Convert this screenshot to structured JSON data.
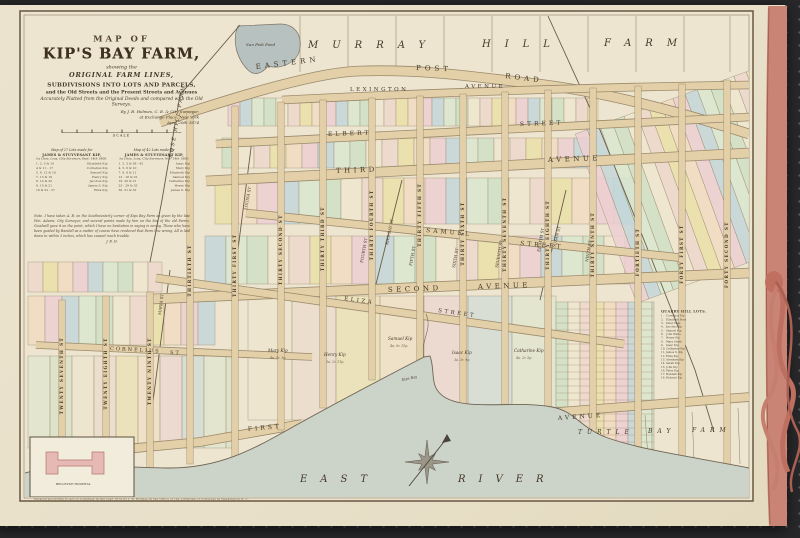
{
  "photo": {
    "bg": "#28282a",
    "paper": "#e9e1ca",
    "cloth": "#c98476",
    "ribbon": "#b86a5c"
  },
  "title_block": {
    "line1": "MAP OF",
    "line2": "KIP'S BAY FARM,",
    "line3": "showing the",
    "line4": "ORIGINAL FARM LINES,",
    "line5": "SUBDIVISIONS INTO LOTS AND PARCELS,",
    "line6": "and the Old Streets and the Present Streets and Avenues",
    "line7": "Accurately Platted from the Original Deeds and compared with the Old Surveys.",
    "by1": "By J. B. Holmes, C. E. & City Surveyor,",
    "by2": "at Exchange Place, New York",
    "by3": "April 20th 1874",
    "scale_label": "SCALE"
  },
  "legend_tables": [
    {
      "title1": "Map of 27 Lots made for",
      "title2": "JAMES & STUYVESANT KIP,",
      "title3": "by Chas. Loss, City Surveyor, Sept. 14th 1806.",
      "rows": [
        [
          "1. 2. 3 & 10",
          "Elizabeth Kip"
        ],
        [
          "4 & 11 - 17",
          "Cornelius Kip"
        ],
        [
          "5. 6. 12 & 18",
          "Samuel Kip"
        ],
        [
          "7. 13 & 19",
          "Henry Kip"
        ],
        [
          "8. 14 & 20",
          "Jacobus Kip"
        ],
        [
          "9. 15 & 21",
          "James S. Kip"
        ],
        [
          "16 & 22 - 27",
          "Eliza Kip"
        ]
      ]
    },
    {
      "title1": "Map of 42 Lots made for",
      "title2": "JAMES & STUYVESANT KIP,",
      "title3": "by Chas. Loss, City Surveyor, Nov. 14th 1806.",
      "rows": [
        [
          "1. 2. 3 & 38 - 42",
          "Isaac Kip"
        ],
        [
          "4. 5. 6 & 10",
          "Mary Kip"
        ],
        [
          "7. 8. 9 & 11",
          "Elizabeth Kip"
        ],
        [
          "12 - 18 & 22",
          "Samuel Kip"
        ],
        [
          "19. 20 & 21",
          "Catharine Kip"
        ],
        [
          "23 - 29 & 33",
          "Henry Kip"
        ],
        [
          "30. 31 & 32",
          "James S. Kip"
        ]
      ]
    }
  ],
  "note": {
    "text": "Note. I have taken A. B. on the Southwesterly corner of Kips Bay Farm as given by the late Wm. Adams, City Surveyor, and several points made by him on the line of the old Farms. Goodwill gave it on the point, which I have no hesitation in saying is wrong. Those who have been guided by Randell as a matter of course have rendered that Farm line wrong. All is laid down to within 3 inches, which has caused much trouble.",
    "sig": "J. B. H."
  },
  "quarry_list": {
    "title": "QUARRY HILL LOTS.",
    "entries": [
      "Cornelius Kip",
      "Elizabeth Ross",
      "Peter Praa",
      "Jacobus Kip",
      "Samuel Kip",
      "John Watts",
      "Henry Kip",
      "Mary Smith",
      "Isaac Kip",
      "Catharine Kip",
      "James S. Kip",
      "Eliza Kip",
      "Abraham Kip",
      "Sarah Kip",
      "John Kip",
      "Peter Kip",
      "Hannah Kip",
      "Richard Kip"
    ]
  },
  "imprint": "Entered according to Act of Congress in the year 1874 by J. B. Holmes in the Office of the Librarian of Congress at Washington D. C.",
  "inset": {
    "label": "BELLEVUE HOSPITAL"
  },
  "map": {
    "colors": {
      "road_fill": "#e3d0a9",
      "road_edge": "#9b8a6b",
      "water": "#ccd3c9",
      "shore": "#6f6553",
      "pond": "#b7c1bf",
      "line": "#8a7a5e",
      "label": "#45382a",
      "lots": [
        "#eccfd2",
        "#cfe0c4",
        "#eae0a9",
        "#c3d7d9",
        "#efe6cf",
        "#f1dcc1",
        "#d9e6cf",
        "#ecd8cc"
      ]
    },
    "roads": [
      {
        "name": "eastern-post-road",
        "d": "M 160 122 C 250 92 320 72 360 71 C 430 69 480 78 530 83 C 610 92 690 115 749 134",
        "w": 9
      },
      {
        "name": "lexington-avenue",
        "d": "M 282 100 C 420 93 600 87 749 85",
        "w": 7
      },
      {
        "name": "elbert-street",
        "d": "M 216 144 L 749 117",
        "w": 7
      },
      {
        "name": "third-avenue",
        "d": "M 206 181 L 749 153",
        "w": 9
      },
      {
        "name": "samuel-street",
        "d": "M 246 213 L 684 258",
        "w": 7
      },
      {
        "name": "second-avenue",
        "d": "M 152 299 L 749 273",
        "w": 9
      },
      {
        "name": "eliza-street",
        "d": "M 156 278 L 624 344",
        "w": 7
      },
      {
        "name": "cornelius-street",
        "d": "M 36 345 L 312 357",
        "w": 6
      },
      {
        "name": "first-avenue-west",
        "d": "M 30 458 L 200 442 L 302 424",
        "w": 8
      },
      {
        "name": "first-avenue-east",
        "d": "M 520 415 L 749 397",
        "w": 8
      }
    ],
    "vertical_streets": [
      {
        "name": "TWENTY SEVENTH ST",
        "x": 62,
        "y1": 300,
        "y2": 468
      },
      {
        "name": "TWENTY EIGHTH ST",
        "x": 106,
        "y1": 296,
        "y2": 468
      },
      {
        "name": "TWENTY NINTH ST",
        "x": 150,
        "y1": 292,
        "y2": 468
      },
      {
        "name": "THIRTIETH ST",
        "x": 190,
        "y1": 112,
        "y2": 464
      },
      {
        "name": "THIRTY FIRST ST",
        "x": 235,
        "y1": 106,
        "y2": 460
      },
      {
        "name": "THIRTY SECOND ST",
        "x": 281,
        "y1": 102,
        "y2": 430
      },
      {
        "name": "THIRTY THIRD ST",
        "x": 323,
        "y1": 100,
        "y2": 408
      },
      {
        "name": "THIRTY FOURTH ST",
        "x": 372,
        "y1": 98,
        "y2": 380
      },
      {
        "name": "THIRTY FIFTH ST",
        "x": 420,
        "y1": 96,
        "y2": 360
      },
      {
        "name": "THIRTY SIXTH ST",
        "x": 463,
        "y1": 94,
        "y2": 404
      },
      {
        "name": "THIRTY SEVENTH ST",
        "x": 505,
        "y1": 92,
        "y2": 408
      },
      {
        "name": "THIRTY EIGHTH ST",
        "x": 548,
        "y1": 90,
        "y2": 412
      },
      {
        "name": "THIRTY NINTH ST",
        "x": 593,
        "y1": 88,
        "y2": 436
      },
      {
        "name": "FORTIETH ST",
        "x": 638,
        "y1": 86,
        "y2": 455
      },
      {
        "name": "FORTY FIRST ST",
        "x": 682,
        "y1": 84,
        "y2": 462
      },
      {
        "name": "FORTY SECOND ST",
        "x": 727,
        "y1": 80,
        "y2": 468
      }
    ],
    "old_street_lines": [
      "M 252 140 L 236 265",
      "M 170 270 L 148 440",
      "M 402 180 L 372 300",
      "M 566 190 L 540 300",
      "M 548 16 L 600 130 L 650 255 L 695 370 L 714 432",
      "M 240 25 L 180 95 L 162 200 L 150 262"
    ],
    "murray_xs": [
      300,
      348,
      396,
      444,
      492,
      540,
      588,
      636,
      684,
      730
    ],
    "turtle_lines": [
      "M 645 415 L 648 458",
      "M 692 412 L 694 460",
      "M 738 408 L 740 464"
    ],
    "lot_bands": [
      {
        "x1": 228,
        "x2": 598,
        "y1": 98,
        "y2": 126,
        "w": 12
      },
      {
        "x1": 222,
        "x2": 598,
        "y1": 138,
        "y2": 168,
        "w": 16
      },
      {
        "x1": 215,
        "x2": 640,
        "y1": 178,
        "y2": 224,
        "w": 21
      },
      {
        "x1": 205,
        "x2": 640,
        "y1": 236,
        "y2": 284,
        "w": 21
      },
      {
        "x1": 248,
        "x2": 556,
        "y1": 296,
        "y2": 420,
        "w": 44,
        "pale": 1
      },
      {
        "x1": 28,
        "x2": 215,
        "y1": 296,
        "y2": 345,
        "w": 17
      },
      {
        "x1": 28,
        "x2": 232,
        "y1": 356,
        "y2": 448,
        "w": 22,
        "pale": 1
      },
      {
        "x1": 28,
        "x2": 162,
        "y1": 262,
        "y2": 292,
        "w": 15
      },
      {
        "x1": 600,
        "x2": 790,
        "y1": 105,
        "y2": 285,
        "w": 13,
        "rot": -20,
        "rcx": 670,
        "rcy": 190
      },
      {
        "x1": 556,
        "x2": 654,
        "y1": 302,
        "y2": 466,
        "w": 12,
        "rows": 7
      }
    ],
    "water": {
      "fill_d": "M 25 473 C 70 460 120 468 170 468 C 225 468 260 445 300 423 C 345 398 395 372 424 357 L 430 356 C 436 372 428 388 446 398 C 470 411 515 400 552 407 C 575 411 580 428 608 438 C 645 451 700 458 749 468 L 749 497 L 25 497 Z",
      "shore_d": "M 25 473 C 70 460 120 468 170 468 C 225 468 260 445 300 423 C 345 398 395 372 424 357 L 430 356 C 436 372 428 388 446 398 C 470 411 515 400 552 407 C 575 411 580 428 608 438 C 645 451 700 458 749 468",
      "creek_d": "M 424 357 C 420 340 433 330 426 314"
    },
    "labels": [
      {
        "t": "MURRAY",
        "x": 308,
        "y": 48,
        "s": 10,
        "ls": 14,
        "i": 1
      },
      {
        "t": "HILL",
        "x": 482,
        "y": 47,
        "s": 10,
        "ls": 14,
        "i": 1
      },
      {
        "t": "FARM",
        "x": 604,
        "y": 46,
        "s": 10,
        "ls": 14,
        "i": 1
      },
      {
        "t": "Sun Fish Pond",
        "x": 246,
        "y": 46,
        "s": 4,
        "i": 1
      },
      {
        "t": "EASTERN",
        "x": 256,
        "y": 69,
        "s": 7,
        "ls": 4,
        "r": -7
      },
      {
        "t": "POST",
        "x": 416,
        "y": 70,
        "s": 7,
        "ls": 4,
        "r": 2
      },
      {
        "t": "ROAD",
        "x": 505,
        "y": 78,
        "s": 7,
        "ls": 4,
        "r": 7
      },
      {
        "t": "LEXINGTON",
        "x": 350,
        "y": 91,
        "s": 5.5,
        "ls": 2.5
      },
      {
        "t": "AVENUE",
        "x": 465,
        "y": 88,
        "s": 5.5,
        "ls": 2.5
      },
      {
        "t": "ELBERT",
        "x": 328,
        "y": 136,
        "s": 6,
        "ls": 3,
        "r": -2
      },
      {
        "t": "STREET",
        "x": 520,
        "y": 126,
        "s": 6,
        "ls": 3,
        "r": -2
      },
      {
        "t": "THIRD",
        "x": 336,
        "y": 173,
        "s": 7,
        "ls": 3.5,
        "r": -2
      },
      {
        "t": "AVENUE",
        "x": 548,
        "y": 162,
        "s": 7,
        "ls": 3.5,
        "r": -2
      },
      {
        "t": "SAMUEL",
        "x": 426,
        "y": 232,
        "s": 6,
        "ls": 3,
        "r": 5
      },
      {
        "t": "STREET",
        "x": 520,
        "y": 245,
        "s": 6,
        "ls": 3,
        "r": 5
      },
      {
        "t": "SECOND",
        "x": 388,
        "y": 292,
        "s": 7,
        "ls": 3.5,
        "r": -2
      },
      {
        "t": "AVENUE",
        "x": 478,
        "y": 289,
        "s": 7,
        "ls": 3.5,
        "r": -2
      },
      {
        "t": "ELIZA",
        "x": 344,
        "y": 300,
        "s": 5.5,
        "ls": 2.5,
        "r": 8
      },
      {
        "t": "STREET",
        "x": 438,
        "y": 312,
        "s": 5.5,
        "ls": 2.5,
        "r": 8
      },
      {
        "t": "CORNELIUS",
        "x": 110,
        "y": 350,
        "s": 5,
        "ls": 2,
        "r": 3
      },
      {
        "t": "ST",
        "x": 170,
        "y": 354,
        "s": 5,
        "ls": 2,
        "r": 3
      },
      {
        "t": "FIRST",
        "x": 248,
        "y": 431,
        "s": 6,
        "ls": 3,
        "r": -5
      },
      {
        "t": "AVENUE",
        "x": 558,
        "y": 420,
        "s": 6,
        "ls": 3,
        "r": -4
      },
      {
        "t": "EAST",
        "x": 300,
        "y": 482,
        "s": 10,
        "ls": 13,
        "i": 1
      },
      {
        "t": "RIVER",
        "x": 458,
        "y": 482,
        "s": 10,
        "ls": 13,
        "i": 1
      },
      {
        "t": "TURTLE",
        "x": 578,
        "y": 434,
        "s": 6,
        "ls": 5,
        "i": 1
      },
      {
        "t": "BAY",
        "x": 648,
        "y": 433,
        "s": 6,
        "ls": 5,
        "i": 1
      },
      {
        "t": "FARM",
        "x": 692,
        "y": 432,
        "s": 6,
        "ls": 5,
        "i": 1
      },
      {
        "t": "ROSE HILL FARM",
        "x": 172,
        "y": 158,
        "s": 5,
        "ls": 2,
        "i": 1,
        "r": -80
      },
      {
        "t": "Kips Bay",
        "x": 402,
        "y": 381,
        "s": 3.5,
        "i": 1,
        "r": -12
      },
      {
        "t": "BELLEVUE HOSPITAL",
        "x": 56,
        "y": 485,
        "s": 3
      }
    ],
    "old_street_labels": [
      {
        "t": "LOUISA ST",
        "x": 247,
        "y": 210,
        "r": -80,
        "s": 4
      },
      {
        "t": "MARIA ST",
        "x": 161,
        "y": 315,
        "r": -83,
        "s": 4
      },
      {
        "t": "KIPS BAY ST",
        "x": 388,
        "y": 245,
        "r": -78,
        "s": 4
      },
      {
        "t": "SUSAN ST",
        "x": 555,
        "y": 248,
        "r": -75,
        "s": 4
      },
      {
        "t": "FOURTH ST",
        "x": 363,
        "y": 263,
        "r": -80,
        "s": 4
      },
      {
        "t": "FIFTH ST",
        "x": 412,
        "y": 266,
        "r": -80,
        "s": 4
      },
      {
        "t": "SIXTH ST",
        "x": 455,
        "y": 268,
        "r": -80,
        "s": 4
      },
      {
        "t": "SEVENTH ST",
        "x": 498,
        "y": 268,
        "r": -80,
        "s": 4
      },
      {
        "t": "EIGHTH ST",
        "x": 540,
        "y": 252,
        "r": -80,
        "s": 4
      },
      {
        "t": "NINTH ST",
        "x": 588,
        "y": 262,
        "r": -80,
        "s": 4
      }
    ],
    "owner_lots": [
      {
        "name": "Mary Kip",
        "sub": "4a. 1r. 3p.",
        "x": 268,
        "y": 352
      },
      {
        "name": "Henry Kip",
        "sub": "3a. 2r. 11p.",
        "x": 324,
        "y": 356
      },
      {
        "name": "Samuel Kip",
        "sub": "4a. 0r. 15p.",
        "x": 388,
        "y": 340
      },
      {
        "name": "Isaac Kip",
        "sub": "3a. 3r. 9p.",
        "x": 452,
        "y": 354
      },
      {
        "name": "Catharine Kip",
        "sub": "4a. 2r. 5p.",
        "x": 514,
        "y": 352
      }
    ],
    "compass": {
      "cx": 427,
      "cy": 462
    }
  }
}
